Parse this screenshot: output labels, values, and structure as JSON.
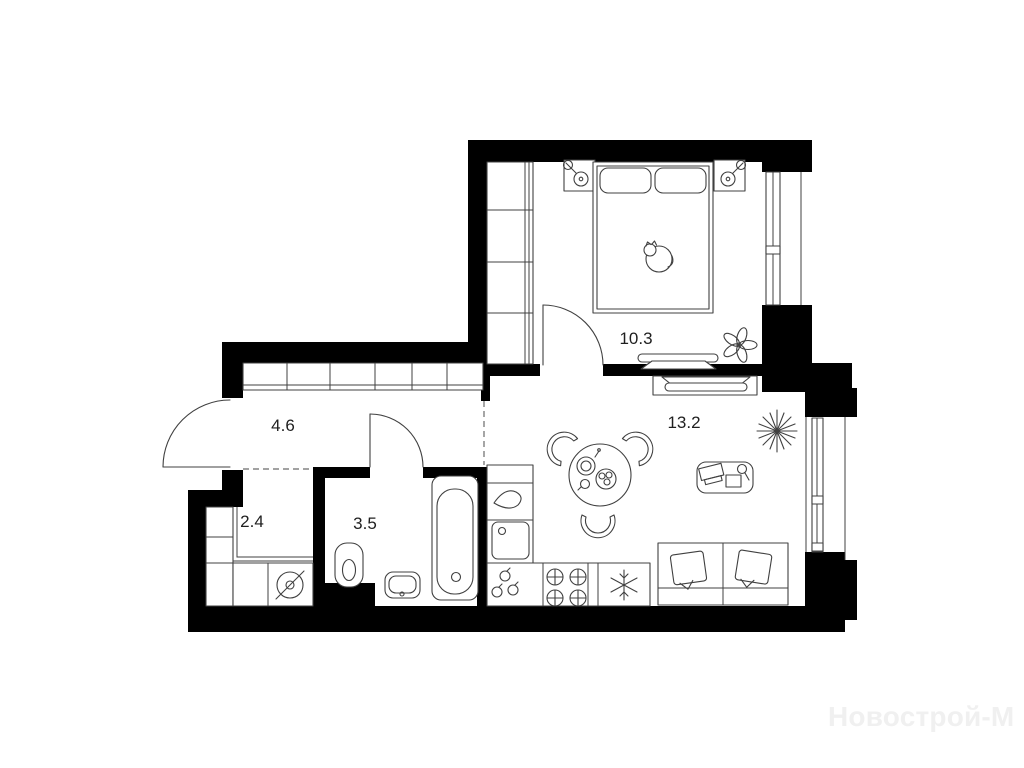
{
  "rooms": {
    "bedroom": {
      "area": "10.3"
    },
    "hallway": {
      "area": "4.6"
    },
    "storage": {
      "area": "2.4"
    },
    "bathroom": {
      "area": "3.5"
    },
    "living_kitchen": {
      "area": "13.2"
    }
  },
  "watermark": {
    "text": "Новострой-М"
  },
  "colors": {
    "walls": "#000000",
    "furniture_lines": "#404040",
    "background": "#ffffff",
    "labels": "#1f1f1f",
    "watermark": "#f0f0f0"
  }
}
